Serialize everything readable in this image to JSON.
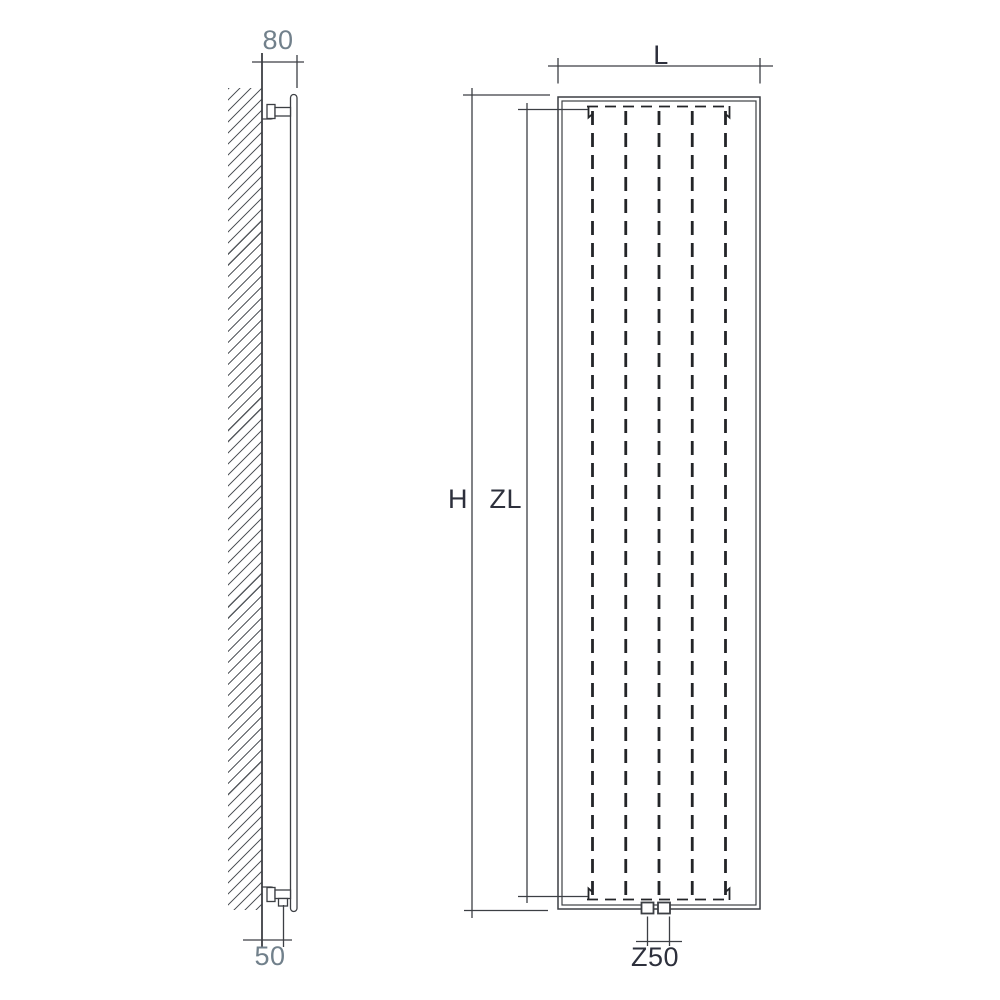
{
  "drawing": {
    "kind": "technical-dimension-drawing",
    "subject": "vertical panel radiator — wall-mounted side view and front view",
    "side_view": {
      "depth_label": "80",
      "offset_label": "50"
    },
    "front_view": {
      "width_label": "L",
      "height_label": "H",
      "element_length_label": "ZL",
      "connection_spacing_label": "Z50",
      "fin_count": 5
    },
    "colors": {
      "line": "#3c3f44",
      "hidden_line": "#232528",
      "hatch": "#565a5f",
      "label_dark": "#2d303c",
      "label_muted": "#71808b",
      "background": "#ffffff"
    }
  }
}
